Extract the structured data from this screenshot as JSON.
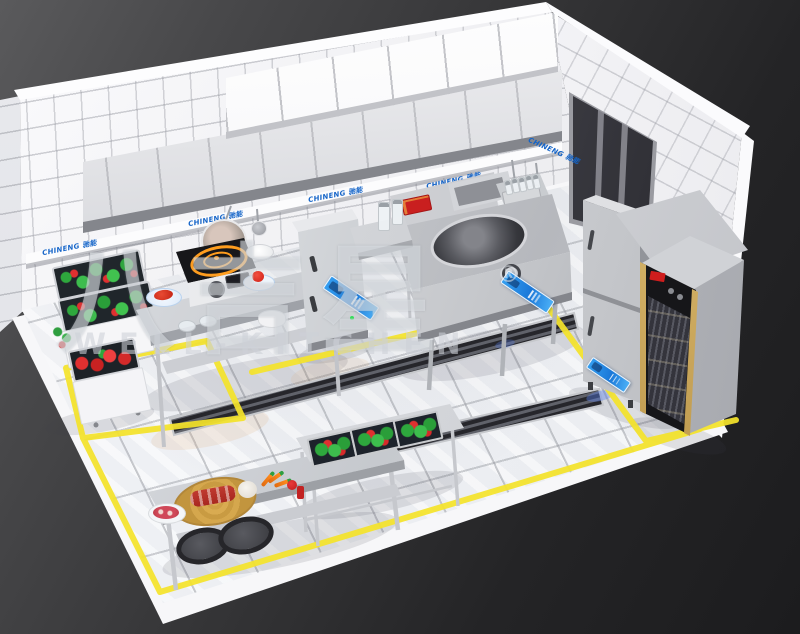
{
  "watermark": {
    "brand_cjk": "八吉星",
    "registered": "®",
    "brand_latin": "WELL-KITCHEN"
  },
  "brand_label": "CHINENG 驰能",
  "colors": {
    "accent_yellow": "#f4e32b",
    "brand_blue": "#1464c8",
    "ribbon_blue": "#1b78d8",
    "alert_red": "#cf1d1d",
    "steel_light": "#e8e9ec",
    "steel_dark": "#9fa2a8",
    "tile_white": "#f2f2f5",
    "background_dark": "#2a2a2c"
  },
  "scene": {
    "type": "3d-isometric-commercial-kitchen-render",
    "room": {
      "walls": "white-tile",
      "floor": "white-marble-tile",
      "background": "dark-gray-gradient"
    },
    "equipment": [
      "exhaust-hood",
      "wall-shelf-row",
      "utensil-rail",
      "hanging-pan",
      "hanging-ladles",
      "vegetable-rack",
      "prep-table-with-induction-cooker",
      "steam-cabinet",
      "wok-range",
      "wall-hand-sink",
      "bottle-caddy",
      "upright-two-door-fridge",
      "disinfection-cabinet",
      "wall-window-panel",
      "front-prep-table",
      "vegetable-sink-table",
      "floor-drain-trenches",
      "yellow-floor-markings"
    ]
  }
}
